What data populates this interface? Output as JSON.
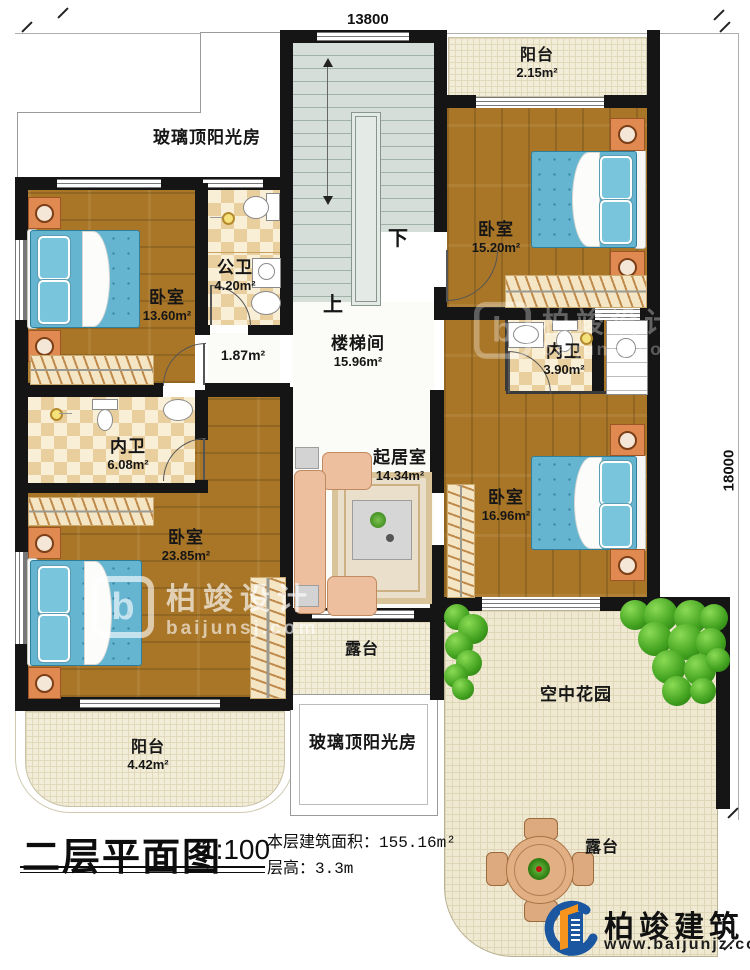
{
  "dimensions": {
    "top": "13800",
    "right": "18000"
  },
  "stairs": {
    "label": "楼梯间",
    "area": "15.96m²",
    "up": "上",
    "down": "下"
  },
  "rooms": {
    "sunroom_top": {
      "label": "玻璃顶阳光房"
    },
    "balcony_top": {
      "label": "阳台",
      "area": "2.15m²"
    },
    "bedroom_tr": {
      "label": "卧室",
      "area": "15.20m²"
    },
    "bedroom_left": {
      "label": "卧室",
      "area": "13.60m²"
    },
    "bath_public": {
      "label": "公卫",
      "area": "4.20m²"
    },
    "hallway": {
      "area": "1.87m²"
    },
    "bath_inner_right": {
      "label": "内卫",
      "area": "3.90m²"
    },
    "bath_inner_left": {
      "label": "内卫",
      "area": "6.08m²"
    },
    "living": {
      "label": "起居室",
      "area": "14.34m²"
    },
    "bedroom_bl": {
      "label": "卧室",
      "area": "23.85m²"
    },
    "bedroom_right": {
      "label": "卧室",
      "area": "16.96m²"
    },
    "terrace_mid": {
      "label": "露台"
    },
    "sunroom_bottom": {
      "label": "玻璃顶阳光房"
    },
    "garden": {
      "label": "空中花园"
    },
    "terrace_br": {
      "label": "露台"
    },
    "balcony_bottom": {
      "label": "阳台",
      "area": "4.42m²"
    }
  },
  "title": {
    "name": "二层平面图",
    "scale": "1:100",
    "area_label": "本层建筑面积：155.16m²",
    "floor_height_label": "层高：3.3m"
  },
  "watermark": {
    "logo_letter": "b",
    "brand": "柏竣设计",
    "site": "baijunsj.com"
  },
  "logo": {
    "brand": "柏竣建筑",
    "site": "www.baijunjz.com"
  },
  "colors": {
    "wall": "#151515",
    "accent_blue": "#1a57a0",
    "accent_orange": "#f7941d",
    "bed": "#65b5d1"
  }
}
